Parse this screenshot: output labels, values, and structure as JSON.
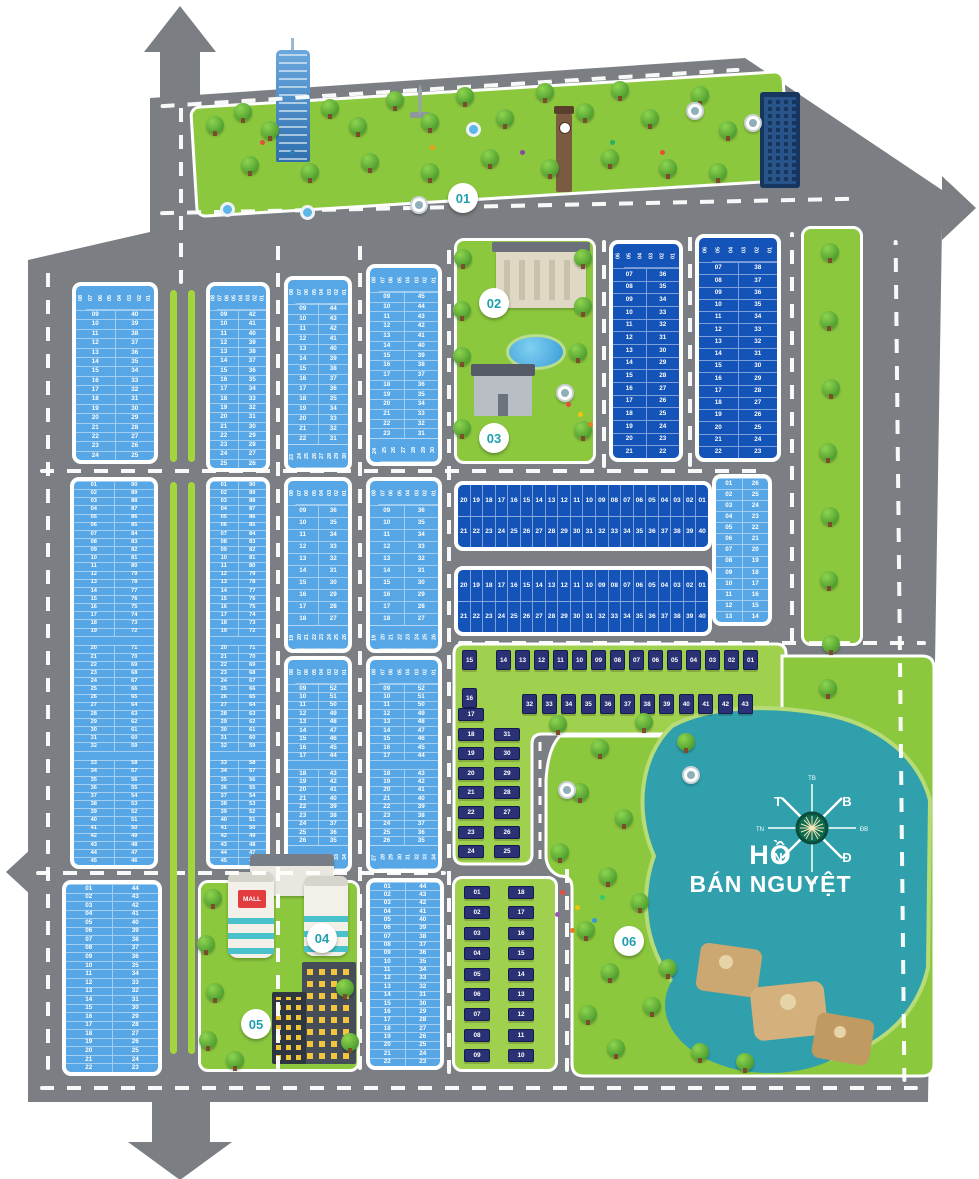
{
  "map": {
    "zone_labels": [
      "01",
      "02",
      "03",
      "04",
      "05",
      "06"
    ],
    "lake": {
      "name_line1": "HỒ",
      "name_line2": "BÁN NGUYỆT"
    },
    "compass": {
      "n": "B",
      "e": "Đ",
      "s": "N",
      "w": "T",
      "ne": "ĐB",
      "nw": "TB",
      "se": "ĐN",
      "sw": "TN"
    },
    "mall_sign": "MALL",
    "colors": {
      "road": "#7b7e82",
      "lot_light": "#57a7e6",
      "lot_dark": "#1453b8",
      "park_green": "#8cc83e",
      "lake_teal": "#2fa0ac",
      "house_navy": "#2a3174",
      "zone_label_text": "#1f9fae",
      "mall_red": "#e23c3f"
    }
  },
  "blocks": {
    "b2a": {
      "kind": "v",
      "header": [
        "08",
        "07",
        "06",
        "05",
        "04",
        "03",
        "02",
        "01"
      ],
      "rows": [
        [
          "09",
          "40"
        ],
        [
          "10",
          "39"
        ],
        [
          "11",
          "38"
        ],
        [
          "12",
          "37"
        ],
        [
          "13",
          "36"
        ],
        [
          "14",
          "35"
        ],
        [
          "15",
          "34"
        ],
        [
          "16",
          "33"
        ],
        [
          "17",
          "32"
        ],
        [
          "18",
          "31"
        ],
        [
          "19",
          "30"
        ],
        [
          "20",
          "29"
        ],
        [
          "21",
          "28"
        ],
        [
          "22",
          "27"
        ],
        [
          "23",
          "26"
        ],
        [
          "24",
          "25"
        ]
      ]
    },
    "b2b": {
      "kind": "v",
      "header": [
        "08",
        "07",
        "06",
        "05",
        "04",
        "03",
        "02",
        "01"
      ],
      "rows": [
        [
          "09",
          "42"
        ],
        [
          "10",
          "41"
        ],
        [
          "11",
          "40"
        ],
        [
          "12",
          "39"
        ],
        [
          "13",
          "38"
        ],
        [
          "14",
          "37"
        ],
        [
          "15",
          "36"
        ],
        [
          "16",
          "35"
        ],
        [
          "17",
          "34"
        ],
        [
          "18",
          "33"
        ],
        [
          "19",
          "32"
        ],
        [
          "20",
          "31"
        ],
        [
          "21",
          "30"
        ],
        [
          "22",
          "29"
        ],
        [
          "23",
          "28"
        ],
        [
          "24",
          "27"
        ],
        [
          "25",
          "26"
        ]
      ]
    },
    "b2c": {
      "kind": "v",
      "header": [
        "08",
        "07",
        "06",
        "05",
        "04",
        "03",
        "02",
        "01"
      ],
      "rows": [
        [
          "09",
          "44"
        ],
        [
          "10",
          "43"
        ],
        [
          "11",
          "42"
        ],
        [
          "12",
          "41"
        ],
        [
          "13",
          "40"
        ],
        [
          "14",
          "39"
        ],
        [
          "15",
          "38"
        ],
        [
          "16",
          "37"
        ],
        [
          "17",
          "36"
        ],
        [
          "18",
          "35"
        ],
        [
          "19",
          "34"
        ],
        [
          "20",
          "33"
        ],
        [
          "21",
          "32"
        ],
        [
          "22",
          "31"
        ]
      ],
      "footer": [
        "23",
        "24",
        "25",
        "26",
        "27",
        "28",
        "29",
        "30"
      ]
    },
    "b2d": {
      "kind": "v",
      "header": [
        "08",
        "07",
        "06",
        "05",
        "04",
        "03",
        "02",
        "01"
      ],
      "rows": [
        [
          "09",
          "45"
        ],
        [
          "10",
          "44"
        ],
        [
          "11",
          "43"
        ],
        [
          "12",
          "42"
        ],
        [
          "13",
          "41"
        ],
        [
          "14",
          "40"
        ],
        [
          "15",
          "39"
        ],
        [
          "16",
          "38"
        ],
        [
          "17",
          "37"
        ],
        [
          "18",
          "36"
        ],
        [
          "19",
          "35"
        ],
        [
          "20",
          "34"
        ],
        [
          "21",
          "33"
        ],
        [
          "22",
          "32"
        ],
        [
          "23",
          "31"
        ]
      ],
      "footer": [
        "24",
        "25",
        "26",
        "27",
        "28",
        "29",
        "30"
      ]
    },
    "b2e": {
      "kind": "v",
      "header": [
        "06",
        "05",
        "04",
        "03",
        "02",
        "01"
      ],
      "rows": [
        [
          "07",
          "36"
        ],
        [
          "08",
          "35"
        ],
        [
          "09",
          "34"
        ],
        [
          "10",
          "33"
        ],
        [
          "11",
          "32"
        ],
        [
          "12",
          "31"
        ],
        [
          "13",
          "30"
        ],
        [
          "14",
          "29"
        ],
        [
          "15",
          "28"
        ],
        [
          "16",
          "27"
        ],
        [
          "17",
          "26"
        ],
        [
          "18",
          "25"
        ],
        [
          "19",
          "24"
        ],
        [
          "20",
          "23"
        ],
        [
          "21",
          "22"
        ]
      ]
    },
    "b2f": {
      "kind": "v",
      "header": [
        "06",
        "05",
        "04",
        "03",
        "02",
        "01"
      ],
      "rows": [
        [
          "07",
          "38"
        ],
        [
          "08",
          "37"
        ],
        [
          "09",
          "36"
        ],
        [
          "10",
          "35"
        ],
        [
          "11",
          "34"
        ],
        [
          "12",
          "33"
        ],
        [
          "13",
          "32"
        ],
        [
          "14",
          "31"
        ],
        [
          "15",
          "30"
        ],
        [
          "16",
          "29"
        ],
        [
          "17",
          "28"
        ],
        [
          "18",
          "27"
        ],
        [
          "19",
          "26"
        ],
        [
          "20",
          "25"
        ],
        [
          "21",
          "24"
        ],
        [
          "22",
          "23"
        ]
      ]
    },
    "m1": {
      "kind": "v",
      "gaps_after": [
        18,
        31
      ],
      "rows": [
        [
          "01",
          "90"
        ],
        [
          "02",
          "89"
        ],
        [
          "03",
          "88"
        ],
        [
          "04",
          "87"
        ],
        [
          "05",
          "86"
        ],
        [
          "06",
          "85"
        ],
        [
          "07",
          "84"
        ],
        [
          "08",
          "83"
        ],
        [
          "09",
          "82"
        ],
        [
          "10",
          "81"
        ],
        [
          "11",
          "80"
        ],
        [
          "12",
          "79"
        ],
        [
          "13",
          "78"
        ],
        [
          "14",
          "77"
        ],
        [
          "15",
          "76"
        ],
        [
          "16",
          "75"
        ],
        [
          "17",
          "74"
        ],
        [
          "18",
          "73"
        ],
        [
          "19",
          "72"
        ],
        [
          "20",
          "71"
        ],
        [
          "21",
          "70"
        ],
        [
          "22",
          "69"
        ],
        [
          "23",
          "68"
        ],
        [
          "24",
          "67"
        ],
        [
          "25",
          "66"
        ],
        [
          "26",
          "65"
        ],
        [
          "27",
          "64"
        ],
        [
          "28",
          "63"
        ],
        [
          "29",
          "62"
        ],
        [
          "30",
          "61"
        ],
        [
          "31",
          "60"
        ],
        [
          "32",
          "59"
        ],
        [
          "33",
          "58"
        ],
        [
          "34",
          "57"
        ],
        [
          "35",
          "56"
        ],
        [
          "36",
          "55"
        ],
        [
          "37",
          "54"
        ],
        [
          "38",
          "53"
        ],
        [
          "39",
          "52"
        ],
        [
          "40",
          "51"
        ],
        [
          "41",
          "50"
        ],
        [
          "42",
          "49"
        ],
        [
          "43",
          "48"
        ],
        [
          "44",
          "47"
        ],
        [
          "45",
          "46"
        ]
      ]
    },
    "m2": {
      "same_as": "m1"
    },
    "m3": {
      "kind": "v",
      "header": [
        "08",
        "07",
        "06",
        "05",
        "04",
        "03",
        "02",
        "01"
      ],
      "rows": [
        [
          "09",
          "36"
        ],
        [
          "10",
          "35"
        ],
        [
          "11",
          "34"
        ],
        [
          "12",
          "33"
        ],
        [
          "13",
          "32"
        ],
        [
          "14",
          "31"
        ],
        [
          "15",
          "30"
        ],
        [
          "16",
          "29"
        ],
        [
          "17",
          "28"
        ],
        [
          "18",
          "27"
        ]
      ],
      "footer": [
        "19",
        "20",
        "21",
        "22",
        "23",
        "24",
        "25",
        "26"
      ]
    },
    "m4": {
      "same_as": "m3"
    },
    "m5": {
      "kind": "h",
      "row_top": [
        "20",
        "19",
        "18",
        "17",
        "16",
        "15",
        "14",
        "13",
        "12",
        "11",
        "10",
        "09",
        "08",
        "07",
        "06",
        "05",
        "04",
        "03",
        "02",
        "01"
      ],
      "row_bottom": [
        "21",
        "22",
        "23",
        "24",
        "25",
        "26",
        "27",
        "28",
        "29",
        "30",
        "31",
        "32",
        "33",
        "34",
        "35",
        "36",
        "37",
        "38",
        "39",
        "40"
      ]
    },
    "m6": {
      "same_as": "m5"
    },
    "m7": {
      "kind": "v",
      "rows": [
        [
          "01",
          "26"
        ],
        [
          "02",
          "25"
        ],
        [
          "03",
          "24"
        ],
        [
          "04",
          "23"
        ],
        [
          "05",
          "22"
        ],
        [
          "06",
          "21"
        ],
        [
          "07",
          "20"
        ],
        [
          "08",
          "19"
        ],
        [
          "09",
          "18"
        ],
        [
          "10",
          "17"
        ],
        [
          "11",
          "16"
        ],
        [
          "12",
          "15"
        ],
        [
          "13",
          "14"
        ]
      ]
    },
    "m8": {
      "kind": "v",
      "header": [
        "08",
        "07",
        "06",
        "05",
        "04",
        "03",
        "02",
        "01"
      ],
      "gaps_after": [
        8
      ],
      "rows": [
        [
          "09",
          "52"
        ],
        [
          "10",
          "51"
        ],
        [
          "11",
          "50"
        ],
        [
          "12",
          "49"
        ],
        [
          "13",
          "48"
        ],
        [
          "14",
          "47"
        ],
        [
          "15",
          "46"
        ],
        [
          "16",
          "45"
        ],
        [
          "17",
          "44"
        ],
        [
          "18",
          "43"
        ],
        [
          "19",
          "42"
        ],
        [
          "20",
          "41"
        ],
        [
          "21",
          "40"
        ],
        [
          "22",
          "39"
        ],
        [
          "23",
          "38"
        ],
        [
          "24",
          "37"
        ],
        [
          "25",
          "36"
        ],
        [
          "26",
          "35"
        ]
      ],
      "footer": [
        "27",
        "28",
        "29",
        "30",
        "31",
        "32",
        "33",
        "34"
      ]
    },
    "m9": {
      "same_as": "m8"
    },
    "bb1": {
      "kind": "v",
      "rows": [
        [
          "01",
          "44"
        ],
        [
          "02",
          "43"
        ],
        [
          "03",
          "42"
        ],
        [
          "04",
          "41"
        ],
        [
          "05",
          "40"
        ],
        [
          "06",
          "39"
        ],
        [
          "07",
          "38"
        ],
        [
          "08",
          "37"
        ],
        [
          "09",
          "36"
        ],
        [
          "10",
          "35"
        ],
        [
          "11",
          "34"
        ],
        [
          "12",
          "33"
        ],
        [
          "13",
          "32"
        ],
        [
          "14",
          "31"
        ],
        [
          "15",
          "30"
        ],
        [
          "16",
          "29"
        ],
        [
          "17",
          "28"
        ],
        [
          "18",
          "27"
        ],
        [
          "19",
          "26"
        ],
        [
          "20",
          "25"
        ],
        [
          "21",
          "24"
        ],
        [
          "22",
          "23"
        ]
      ]
    },
    "bb4": {
      "same_as": "bb1"
    }
  },
  "house_zones": {
    "villas": {
      "row1": [
        "15",
        "14",
        "13",
        "12",
        "11",
        "10",
        "09",
        "08",
        "07",
        "06",
        "05",
        "04",
        "03",
        "02",
        "01"
      ],
      "row2": [
        "16",
        "32",
        "33",
        "34",
        "35",
        "36",
        "37",
        "38",
        "39",
        "40",
        "41",
        "42",
        "43"
      ],
      "col1": [
        "17",
        "18",
        "19",
        "20",
        "21",
        "22",
        "23",
        "24"
      ],
      "col2": [
        "31",
        "30",
        "29",
        "28",
        "27",
        "26",
        "25"
      ]
    },
    "bottom": {
      "col1": [
        "01",
        "02",
        "03",
        "04",
        "05",
        "06",
        "07",
        "08",
        "09"
      ],
      "col2": [
        "18",
        "17",
        "16",
        "15",
        "14",
        "13",
        "12",
        "11",
        "10"
      ]
    }
  }
}
